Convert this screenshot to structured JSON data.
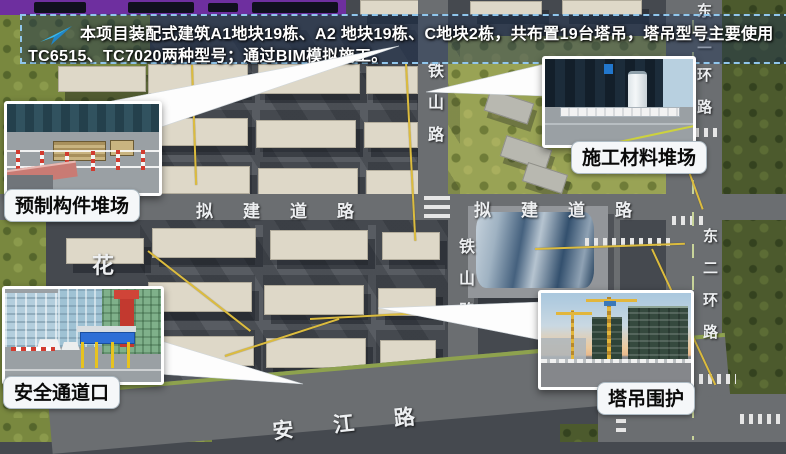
{
  "banner": {
    "line1": "本项目装配式建筑A1地块19栋、A2 地块19栋、C地块2栋，共布置19台塔吊，塔吊型号主要使用",
    "line2": "TC6515、TC7020两种型号；通过BIM模拟施工。"
  },
  "callouts": {
    "precast": "预制构件堆场",
    "materials": "施工材料堆场",
    "safety": "安全通道口",
    "crane": "塔吊围护"
  },
  "roads": {
    "tieshan_upper": "铁山路",
    "tieshan_lower": "铁山路",
    "proposed_left": "拟建道路",
    "proposed_right": "拟建道路",
    "ring_upper": "东二环路",
    "ring_lower": "东二环路",
    "hua": "花",
    "anjiang": "安江路"
  },
  "colors": {
    "accent_purple": "#6e2f9f",
    "banner_dash": "#90c6ec",
    "arrow_cyan": "#2fb3e8",
    "crane_yellow": "#dcbc3e",
    "building_cream": "#ded8c8",
    "road_gray": "#6b6e71"
  }
}
